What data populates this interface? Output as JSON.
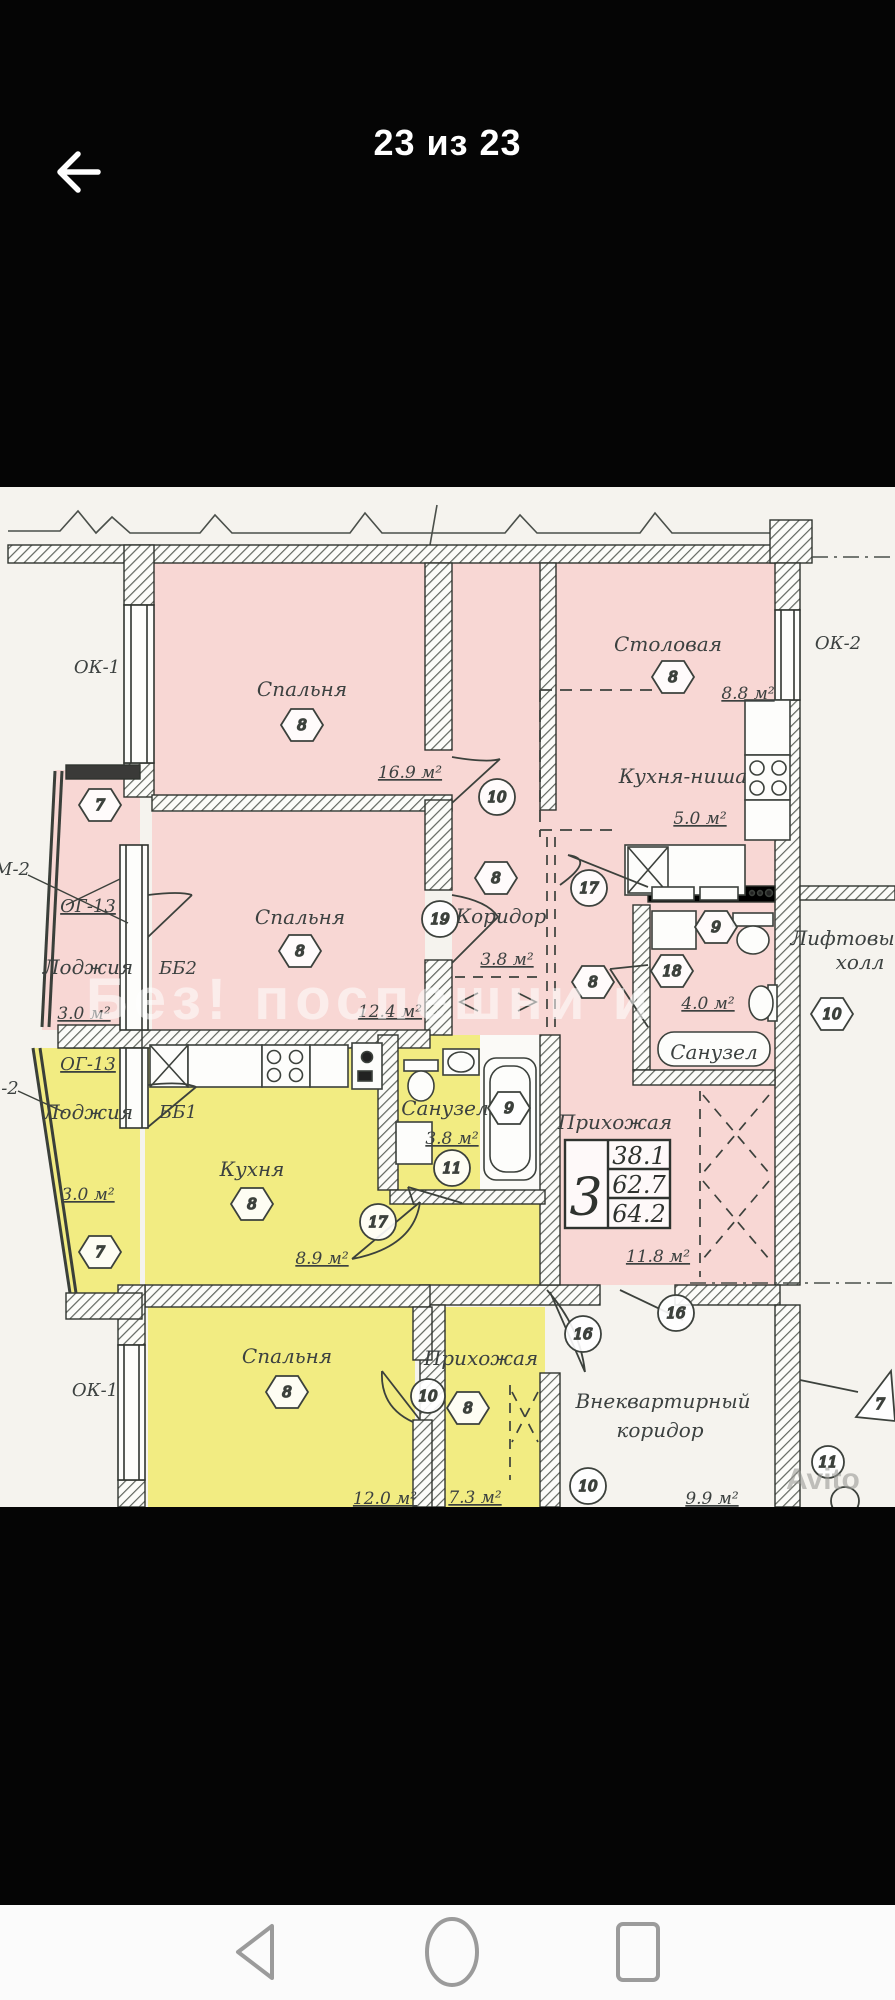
{
  "header": {
    "title": "23 из 23"
  },
  "plan": {
    "watermark": "Без! поспешни и",
    "brand_watermark": "Avito",
    "window_labels": {
      "ok1_top": "ОК-1",
      "ok1_bottom": "ОК-1",
      "ok2": "ОК-2",
      "og13_top": "ОГ-13",
      "og13_bottom": "ОГ-13",
      "m2_top": "М-2",
      "m2_bottom": "-2",
      "bb2": "ББ2",
      "bb1": "ББ1"
    },
    "rooms": {
      "bedroom1": {
        "name": "Спальня",
        "marker": "8",
        "area": "16.9 м²"
      },
      "dining": {
        "name": "Столовая",
        "marker": "8",
        "area": "8.8 м²"
      },
      "kitchen_niche": {
        "name": "Кухня-ниша",
        "area": "5.0 м²"
      },
      "loggia_top": {
        "name": "Лоджия",
        "marker": "7",
        "area": "3.0 м²"
      },
      "bedroom2": {
        "name": "Спальня",
        "marker": "8",
        "area": "12.4 м²"
      },
      "corridor": {
        "name": "Коридор",
        "marker": "8",
        "area": "3.8 м²"
      },
      "hall": {
        "marker": "8"
      },
      "bathroom1": {
        "name": "Санузел",
        "marker_a": "9",
        "marker_b": "18",
        "area": "4.0 м²"
      },
      "lift_hall": {
        "name_line1": "Лифтовый",
        "name_line2": "холл",
        "marker": "10"
      },
      "entry_hall": {
        "name": "Прихожая",
        "area": "11.8 м²"
      },
      "outer_corridor": {
        "name_line1": "Внеквартирный",
        "name_line2": "коридор",
        "marker": "10",
        "area": "9.9 м²"
      },
      "loggia_bottom": {
        "name": "Лоджия",
        "marker": "7",
        "area": "3.0 м²"
      },
      "kitchen": {
        "name": "Кухня",
        "marker": "8",
        "area": "8.9 м²"
      },
      "bathroom2": {
        "name": "Санузел",
        "marker_tub": "9",
        "marker_door": "11",
        "area": "3.8 м²"
      },
      "bedroom3": {
        "name": "Спальня",
        "marker": "8",
        "area": "12.0 м²"
      },
      "entry_hall2": {
        "name": "Прихожая",
        "marker_a": "10",
        "marker_b": "8",
        "area": "7.3 м²"
      }
    },
    "door_markers": {
      "d10_top": "10",
      "d19": "19",
      "d17_top": "17",
      "d16_a": "16",
      "d16_b": "16",
      "d17_kitchen": "17",
      "d7_triangle": "7",
      "d11_br": "11"
    },
    "stamp": {
      "rooms_count": "3",
      "area_living": "38.1",
      "area_total": "62.7",
      "area_full": "64.2"
    }
  }
}
